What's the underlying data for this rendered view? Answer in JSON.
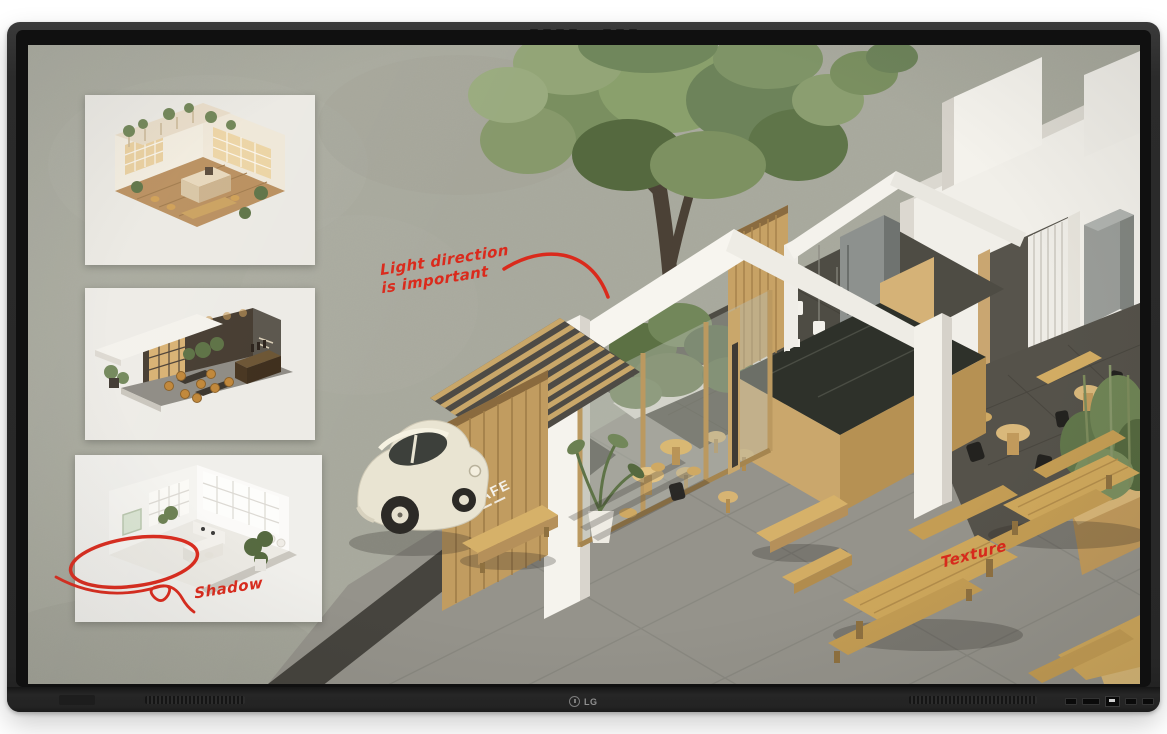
{
  "display": {
    "brand_logo": "LG"
  },
  "screen_content": {
    "annotations": {
      "light_direction_line1": "Light direction",
      "light_direction_line2": "is important",
      "shadow_label": "Shadow",
      "texture_label": "Texture",
      "ink_color": "#da2a1c"
    },
    "cafe_scene": {
      "sign_text": "CAFE"
    },
    "insets": {
      "top": "warm-cafe-interior-render",
      "middle": "dark-lounge-interior-render",
      "bottom": "white-studio-interior-render"
    },
    "palette": {
      "backdrop_concrete": "#a8a99d",
      "pavement_gray": "#95938b",
      "wood_light": "#d2ac63",
      "wall_white": "#f4f2ec",
      "counter_marble": "#2e312a",
      "foliage_green": "#7d9161",
      "car_cream": "#e9e4d2",
      "interior_stone_dark": "#4e4c44"
    }
  }
}
